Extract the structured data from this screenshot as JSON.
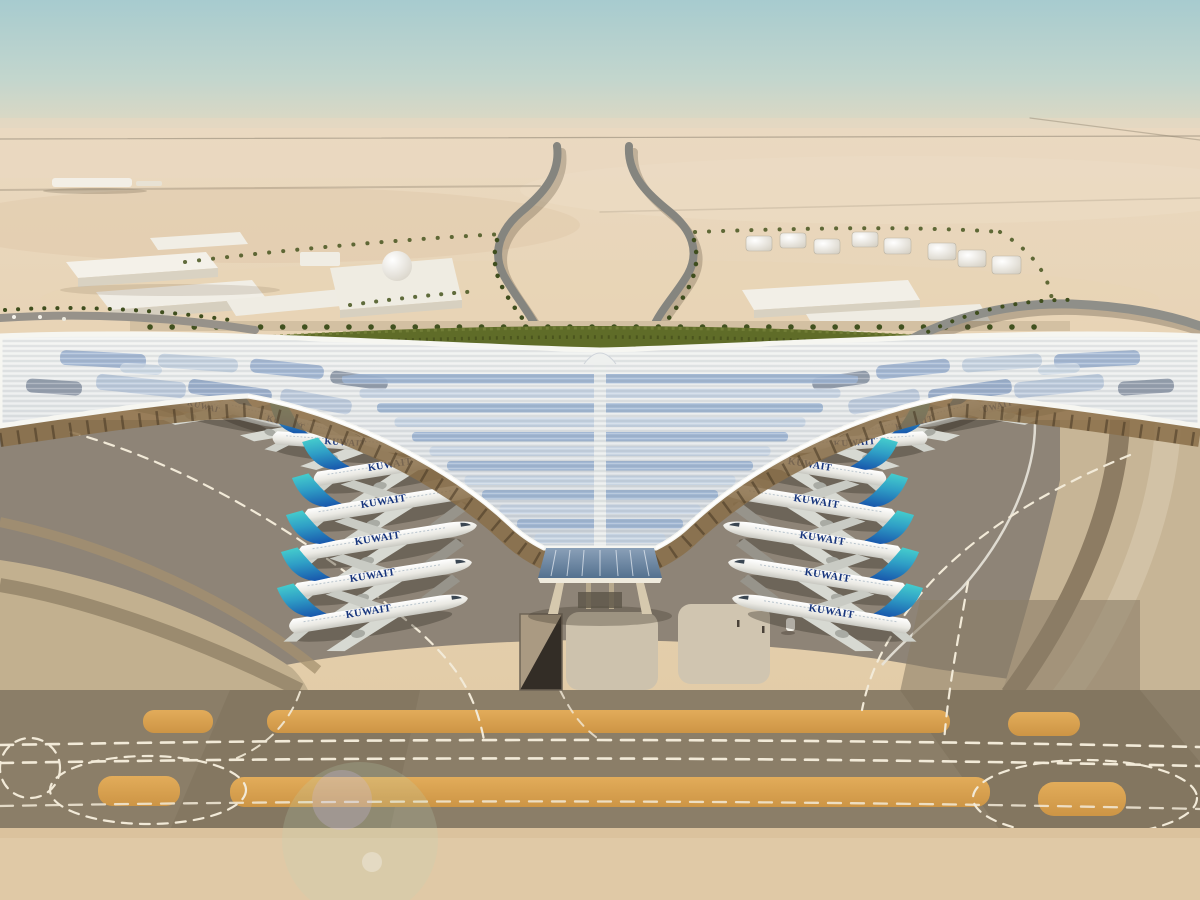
{
  "airline": {
    "name": "KUWAIT"
  },
  "fleet": {
    "parked_count": 20,
    "aircraft": [
      {
        "x": 50,
        "y": 380,
        "r": 14,
        "s": 0.78,
        "m": false
      },
      {
        "x": 135,
        "y": 393,
        "r": 14,
        "s": 0.8,
        "m": false
      },
      {
        "x": 215,
        "y": 407,
        "r": 14,
        "s": 0.82,
        "m": false
      },
      {
        "x": 295,
        "y": 423,
        "r": 14,
        "s": 0.84,
        "m": false
      },
      {
        "x": 356,
        "y": 443,
        "r": 4,
        "s": 0.9,
        "m": false
      },
      {
        "x": 402,
        "y": 465,
        "r": -9,
        "s": 0.96,
        "m": false
      },
      {
        "x": 396,
        "y": 502,
        "r": -9,
        "s": 1.0,
        "m": false
      },
      {
        "x": 390,
        "y": 539,
        "r": -9,
        "s": 1.0,
        "m": false
      },
      {
        "x": 385,
        "y": 576,
        "r": -9,
        "s": 1.0,
        "m": false
      },
      {
        "x": 381,
        "y": 612,
        "r": -9,
        "s": 1.0,
        "m": false
      },
      {
        "x": 1150,
        "y": 380,
        "r": 14,
        "s": 0.78,
        "m": true
      },
      {
        "x": 1065,
        "y": 393,
        "r": 14,
        "s": 0.8,
        "m": true
      },
      {
        "x": 985,
        "y": 407,
        "r": 14,
        "s": 0.82,
        "m": true
      },
      {
        "x": 905,
        "y": 423,
        "r": 14,
        "s": 0.84,
        "m": true
      },
      {
        "x": 844,
        "y": 443,
        "r": 4,
        "s": 0.9,
        "m": true
      },
      {
        "x": 798,
        "y": 465,
        "r": -9,
        "s": 0.96,
        "m": true
      },
      {
        "x": 804,
        "y": 502,
        "r": -9,
        "s": 1.0,
        "m": true
      },
      {
        "x": 810,
        "y": 539,
        "r": -9,
        "s": 1.0,
        "m": true
      },
      {
        "x": 815,
        "y": 576,
        "r": -9,
        "s": 1.0,
        "m": true
      },
      {
        "x": 819,
        "y": 612,
        "r": -9,
        "s": 1.0,
        "m": true
      }
    ]
  },
  "palette": {
    "sky_top": "#a7cbcf",
    "sky_horizon": "#ead9c2",
    "desert": "#e6d2b4",
    "desert_foreground": "#dfc6a0",
    "apron_gray": "#8e8477",
    "taxiway_band": "#8b7e68",
    "marking_ochre": "#d6a04e",
    "marking_white": "#f2ead8",
    "roof_white": "#e9ebe9",
    "roof_glazing_blue": "#9db4d1",
    "greenery": "#5f6c28",
    "under_canopy_gold": "#8a6f49",
    "tail_teal": "#3fc4c6",
    "tail_blue": "#1b5cb0",
    "titles_blue": "#17357d"
  }
}
